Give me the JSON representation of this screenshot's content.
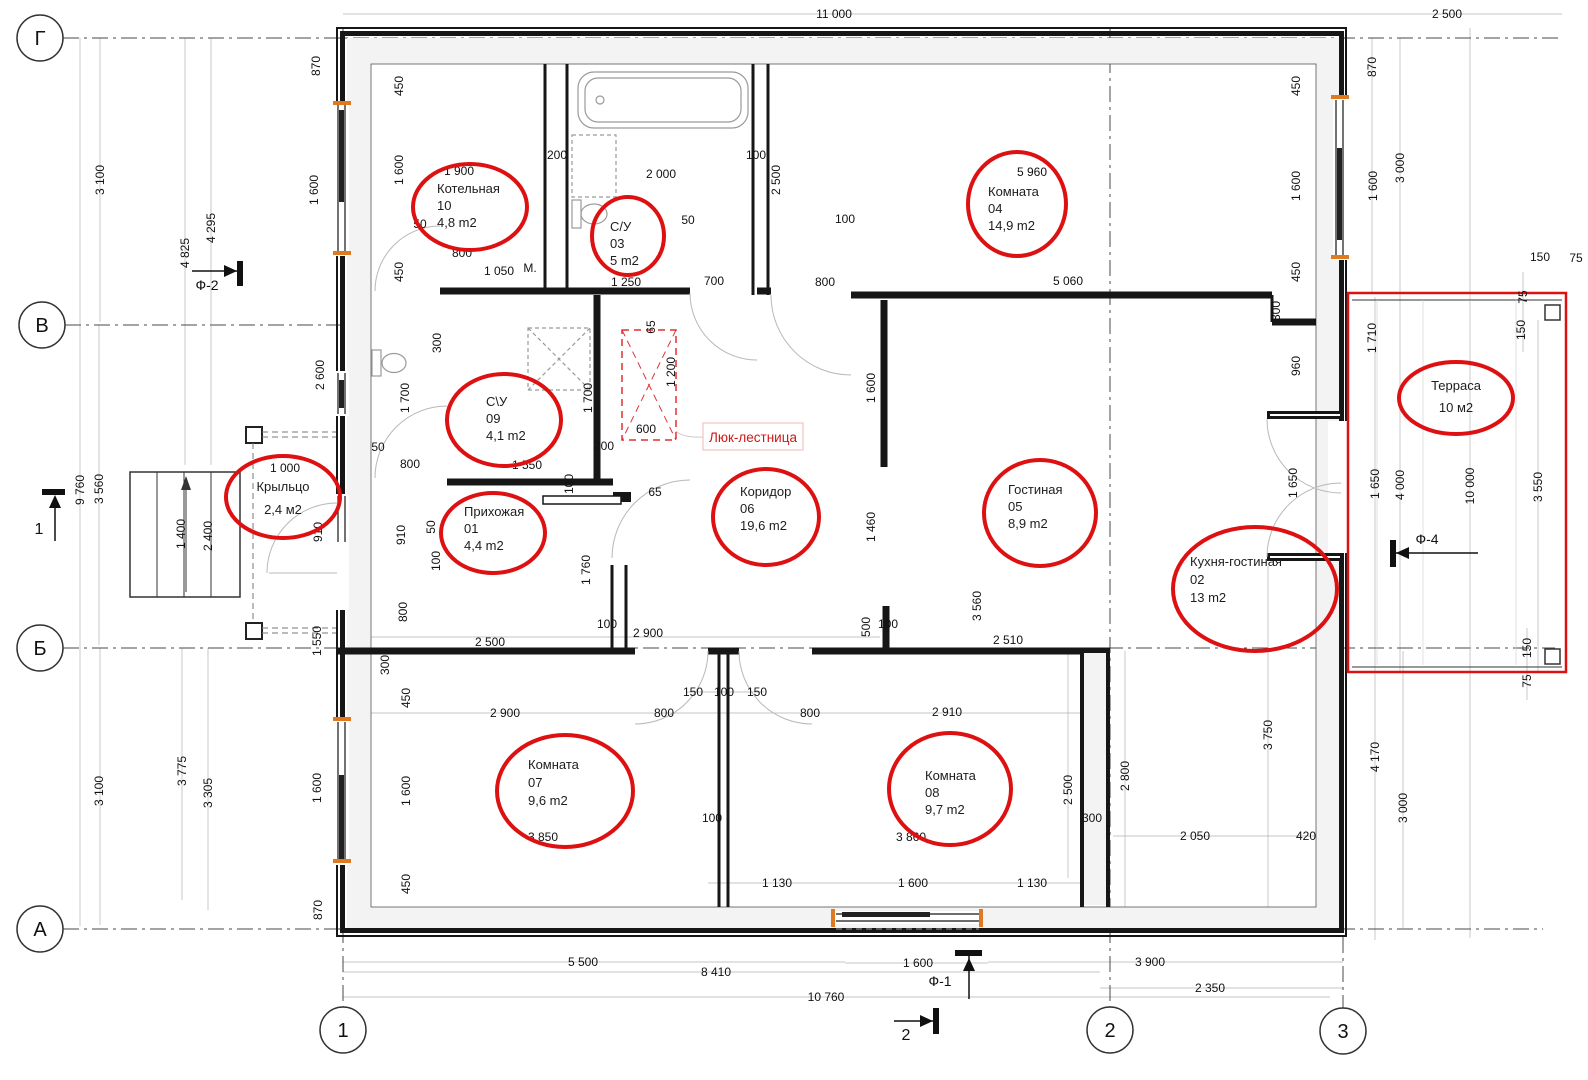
{
  "drawing": {
    "type": "floor-plan",
    "language": "ru",
    "accent_red": "#dd1111",
    "wall_color": "#161616",
    "window_tick_orange": "#e07a20"
  },
  "axes": {
    "rows": [
      {
        "label": "Г",
        "x": 40,
        "y": 38
      },
      {
        "label": "В",
        "x": 42,
        "y": 325
      },
      {
        "label": "Б",
        "x": 40,
        "y": 648
      },
      {
        "label": "А",
        "x": 40,
        "y": 929
      }
    ],
    "cols": [
      {
        "label": "1",
        "x": 343,
        "y": 1030
      },
      {
        "label": "2",
        "x": 1110,
        "y": 1030
      },
      {
        "label": "3",
        "x": 1343,
        "y": 1031
      }
    ]
  },
  "markers": {
    "f2": {
      "label": "Ф-2"
    },
    "f1": {
      "label": "Ф-1"
    },
    "f4": {
      "label": "Ф-4"
    },
    "s1": {
      "label": "1"
    },
    "s2": {
      "label": "2"
    }
  },
  "annotations": {
    "hatch_label": "Люк-лестница"
  },
  "rooms": [
    {
      "lines": [
        "Котельная",
        "10",
        "4,8 m2"
      ],
      "x": 437,
      "y": 193,
      "dy": 17,
      "size": 13,
      "ell": [
        470,
        207,
        57,
        43
      ]
    },
    {
      "lines": [
        "С/У",
        "03",
        "5 m2"
      ],
      "x": 610,
      "y": 231,
      "dy": 17,
      "size": 13,
      "ell": [
        628,
        236,
        36,
        39
      ]
    },
    {
      "lines": [
        "Комната",
        "04",
        "14,9 m2"
      ],
      "x": 988,
      "y": 196,
      "dy": 17,
      "size": 13,
      "ell": [
        1017,
        204,
        49,
        52
      ]
    },
    {
      "lines": [
        "С\\У",
        "09",
        "4,1 m2"
      ],
      "x": 486,
      "y": 406,
      "dy": 17,
      "size": 13,
      "ell": [
        504,
        420,
        57,
        46
      ]
    },
    {
      "lines": [
        "Прихожая",
        "01",
        "4,4 m2"
      ],
      "x": 464,
      "y": 516,
      "dy": 17,
      "size": 13,
      "ell": [
        493,
        533,
        52,
        40
      ]
    },
    {
      "lines": [
        "Коридор",
        "06",
        "19,6 m2"
      ],
      "x": 740,
      "y": 496,
      "dy": 17,
      "size": 13,
      "ell": [
        766,
        517,
        53,
        48
      ]
    },
    {
      "lines": [
        "Гостиная",
        "05",
        "8,9 m2"
      ],
      "x": 1008,
      "y": 494,
      "dy": 17,
      "size": 13,
      "ell": [
        1040,
        513,
        56,
        53
      ]
    },
    {
      "lines": [
        "Кухня-гостиная",
        "02",
        "13 m2"
      ],
      "x": 1190,
      "y": 566,
      "dy": 18,
      "size": 13,
      "ell": [
        1255,
        589,
        82,
        62
      ]
    },
    {
      "lines": [
        "Комната",
        "07",
        "9,6 m2"
      ],
      "x": 528,
      "y": 769,
      "dy": 18,
      "size": 13,
      "ell": [
        565,
        791,
        68,
        56
      ]
    },
    {
      "lines": [
        "Комната",
        "08",
        "9,7 m2"
      ],
      "x": 925,
      "y": 780,
      "dy": 17,
      "size": 13,
      "ell": [
        950,
        789,
        61,
        56
      ]
    },
    {
      "lines": [
        "Крыльцо",
        "2,4 м2"
      ],
      "x": 283,
      "y": 491,
      "dy": 23,
      "size": 16,
      "center": 1,
      "ell": [
        283,
        497,
        57,
        41
      ]
    },
    {
      "lines": [
        "Терраса",
        "10 м2"
      ],
      "x": 1456,
      "y": 390,
      "dy": 22,
      "size": 15,
      "center": 1,
      "ell": [
        1456,
        398,
        57,
        36
      ]
    }
  ],
  "dims": [
    {
      "t": "11 000",
      "x": 834,
      "y": 14
    },
    {
      "t": "2 500",
      "x": 1447,
      "y": 14
    },
    {
      "t": "3 100",
      "x": 100,
      "y": 180,
      "v": 1
    },
    {
      "t": "4 825",
      "x": 185,
      "y": 253,
      "v": 1
    },
    {
      "t": "4 295",
      "x": 211,
      "y": 228,
      "v": 1
    },
    {
      "t": "870",
      "x": 316,
      "y": 66,
      "v": 1
    },
    {
      "t": "1 600",
      "x": 314,
      "y": 190,
      "v": 1
    },
    {
      "t": "450",
      "x": 399,
      "y": 86,
      "v": 1
    },
    {
      "t": "1 600",
      "x": 399,
      "y": 170,
      "v": 1
    },
    {
      "t": "450",
      "x": 399,
      "y": 272,
      "v": 1
    },
    {
      "t": "1 900",
      "x": 459,
      "y": 171
    },
    {
      "t": "50",
      "x": 420,
      "y": 224
    },
    {
      "t": "800",
      "x": 462,
      "y": 253
    },
    {
      "t": "1 050",
      "x": 499,
      "y": 271
    },
    {
      "t": "М.",
      "x": 530,
      "y": 268
    },
    {
      "t": "200",
      "x": 557,
      "y": 155
    },
    {
      "t": "2 000",
      "x": 661,
      "y": 174
    },
    {
      "t": "100",
      "x": 756,
      "y": 155
    },
    {
      "t": "2 500",
      "x": 776,
      "y": 180,
      "v": 1
    },
    {
      "t": "50",
      "x": 688,
      "y": 220
    },
    {
      "t": "100",
      "x": 845,
      "y": 219
    },
    {
      "t": "1 250",
      "x": 626,
      "y": 282
    },
    {
      "t": "700",
      "x": 714,
      "y": 281
    },
    {
      "t": "800",
      "x": 825,
      "y": 282
    },
    {
      "t": "5 960",
      "x": 1032,
      "y": 172
    },
    {
      "t": "5 060",
      "x": 1068,
      "y": 281
    },
    {
      "t": "450",
      "x": 1296,
      "y": 86,
      "v": 1
    },
    {
      "t": "1 600",
      "x": 1296,
      "y": 186,
      "v": 1
    },
    {
      "t": "450",
      "x": 1296,
      "y": 272,
      "v": 1
    },
    {
      "t": "870",
      "x": 1372,
      "y": 67,
      "v": 1
    },
    {
      "t": "1 600",
      "x": 1373,
      "y": 186,
      "v": 1
    },
    {
      "t": "3 000",
      "x": 1400,
      "y": 168,
      "v": 1
    },
    {
      "t": "300",
      "x": 1276,
      "y": 311,
      "v": 1
    },
    {
      "t": "960",
      "x": 1296,
      "y": 366,
      "v": 1
    },
    {
      "t": "2 600",
      "x": 320,
      "y": 375,
      "v": 1
    },
    {
      "t": "300",
      "x": 437,
      "y": 343,
      "v": 1
    },
    {
      "t": "1 700",
      "x": 405,
      "y": 398,
      "v": 1
    },
    {
      "t": "1 700",
      "x": 588,
      "y": 398,
      "v": 1
    },
    {
      "t": "50",
      "x": 378,
      "y": 447
    },
    {
      "t": "800",
      "x": 410,
      "y": 464
    },
    {
      "t": "1 550",
      "x": 527,
      "y": 465
    },
    {
      "t": "200",
      "x": 604,
      "y": 446
    },
    {
      "t": "65",
      "x": 651,
      "y": 327,
      "v": 1
    },
    {
      "t": "600",
      "x": 646,
      "y": 429
    },
    {
      "t": "1 200",
      "x": 671,
      "y": 372,
      "v": 1
    },
    {
      "t": "100",
      "x": 569,
      "y": 484,
      "v": 1
    },
    {
      "t": "910",
      "x": 318,
      "y": 532,
      "v": 1
    },
    {
      "t": "910",
      "x": 401,
      "y": 535,
      "v": 1
    },
    {
      "t": "50",
      "x": 431,
      "y": 527,
      "v": 1
    },
    {
      "t": "100",
      "x": 436,
      "y": 561,
      "v": 1
    },
    {
      "t": "1 000",
      "x": 285,
      "y": 468
    },
    {
      "t": "9 760",
      "x": 80,
      "y": 490,
      "v": 1
    },
    {
      "t": "3 560",
      "x": 99,
      "y": 489,
      "v": 1
    },
    {
      "t": "1 400",
      "x": 181,
      "y": 534,
      "v": 1
    },
    {
      "t": "2 400",
      "x": 208,
      "y": 536,
      "v": 1
    },
    {
      "t": "1 550",
      "x": 317,
      "y": 641,
      "v": 1
    },
    {
      "t": "800",
      "x": 403,
      "y": 612,
      "v": 1
    },
    {
      "t": "2 500",
      "x": 490,
      "y": 642
    },
    {
      "t": "300",
      "x": 385,
      "y": 665,
      "v": 1
    },
    {
      "t": "450",
      "x": 406,
      "y": 698,
      "v": 1
    },
    {
      "t": "1 600",
      "x": 406,
      "y": 791,
      "v": 1
    },
    {
      "t": "450",
      "x": 406,
      "y": 884,
      "v": 1
    },
    {
      "t": "870",
      "x": 318,
      "y": 910,
      "v": 1
    },
    {
      "t": "1 600",
      "x": 317,
      "y": 788,
      "v": 1
    },
    {
      "t": "1 760",
      "x": 586,
      "y": 570,
      "v": 1
    },
    {
      "t": "100",
      "x": 607,
      "y": 624
    },
    {
      "t": "2 900",
      "x": 648,
      "y": 633
    },
    {
      "t": "65",
      "x": 655,
      "y": 492
    },
    {
      "t": "2 900",
      "x": 505,
      "y": 713
    },
    {
      "t": "150",
      "x": 693,
      "y": 692
    },
    {
      "t": "100",
      "x": 724,
      "y": 692
    },
    {
      "t": "150",
      "x": 757,
      "y": 692
    },
    {
      "t": "800",
      "x": 664,
      "y": 713
    },
    {
      "t": "800",
      "x": 810,
      "y": 713
    },
    {
      "t": "100",
      "x": 712,
      "y": 818
    },
    {
      "t": "2 910",
      "x": 947,
      "y": 712
    },
    {
      "t": "1 600",
      "x": 871,
      "y": 388,
      "v": 1
    },
    {
      "t": "1 460",
      "x": 871,
      "y": 527,
      "v": 1
    },
    {
      "t": "500",
      "x": 866,
      "y": 627,
      "v": 1
    },
    {
      "t": "100",
      "x": 888,
      "y": 624
    },
    {
      "t": "2 510",
      "x": 1008,
      "y": 640
    },
    {
      "t": "3 560",
      "x": 977,
      "y": 606,
      "v": 1
    },
    {
      "t": "1 650",
      "x": 1293,
      "y": 483,
      "v": 1
    },
    {
      "t": "1 650",
      "x": 1375,
      "y": 484,
      "v": 1
    },
    {
      "t": "4 000",
      "x": 1400,
      "y": 485,
      "v": 1
    },
    {
      "t": "10 000",
      "x": 1470,
      "y": 486,
      "v": 1
    },
    {
      "t": "3 550",
      "x": 1538,
      "y": 487,
      "v": 1
    },
    {
      "t": "1 710",
      "x": 1372,
      "y": 338,
      "v": 1
    },
    {
      "t": "75",
      "x": 1523,
      "y": 297,
      "v": 1
    },
    {
      "t": "150",
      "x": 1521,
      "y": 330,
      "v": 1
    },
    {
      "t": "150",
      "x": 1540,
      "y": 257
    },
    {
      "t": "75",
      "x": 1576,
      "y": 258
    },
    {
      "t": "2 500",
      "x": 1068,
      "y": 790,
      "v": 1
    },
    {
      "t": "300",
      "x": 1092,
      "y": 818
    },
    {
      "t": "2 800",
      "x": 1125,
      "y": 776,
      "v": 1
    },
    {
      "t": "3 750",
      "x": 1268,
      "y": 735,
      "v": 1
    },
    {
      "t": "2 050",
      "x": 1195,
      "y": 836
    },
    {
      "t": "420",
      "x": 1306,
      "y": 836
    },
    {
      "t": "4 170",
      "x": 1375,
      "y": 757,
      "v": 1
    },
    {
      "t": "3 000",
      "x": 1403,
      "y": 808,
      "v": 1
    },
    {
      "t": "150",
      "x": 1527,
      "y": 648,
      "v": 1
    },
    {
      "t": "75",
      "x": 1527,
      "y": 681,
      "v": 1
    },
    {
      "t": "3 100",
      "x": 99,
      "y": 791,
      "v": 1
    },
    {
      "t": "3 775",
      "x": 182,
      "y": 771,
      "v": 1
    },
    {
      "t": "3 305",
      "x": 208,
      "y": 793,
      "v": 1
    },
    {
      "t": "1 130",
      "x": 777,
      "y": 883
    },
    {
      "t": "1 600",
      "x": 913,
      "y": 883
    },
    {
      "t": "1 130",
      "x": 1032,
      "y": 883
    },
    {
      "t": "3 850",
      "x": 543,
      "y": 837
    },
    {
      "t": "3 860",
      "x": 911,
      "y": 837
    },
    {
      "t": "1 600",
      "x": 918,
      "y": 963
    },
    {
      "t": "5 500",
      "x": 583,
      "y": 962
    },
    {
      "t": "8 410",
      "x": 716,
      "y": 972
    },
    {
      "t": "10 760",
      "x": 826,
      "y": 997
    },
    {
      "t": "3 900",
      "x": 1150,
      "y": 962
    },
    {
      "t": "2 350",
      "x": 1210,
      "y": 988
    }
  ]
}
